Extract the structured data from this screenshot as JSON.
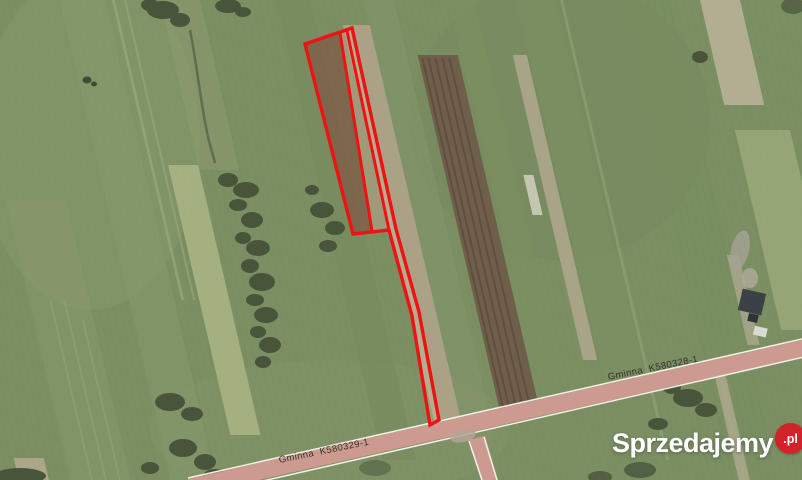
{
  "map": {
    "type": "aerial-satellite-view",
    "road_labels": [
      {
        "text": "Gminna  K580329-1"
      },
      {
        "text": "Gminna  K580328-1"
      }
    ],
    "road_surface_color": "#cc9a8e"
  },
  "parcel": {
    "outline_color": "#ee1212",
    "outer_points": "305,44 352,28 396,229 419,312 439,420 430,425 412,316 389,230 353,234",
    "divider_a_points": "340,33 372,231",
    "divider_b_points": "347,31 389,230",
    "fill_left_points": "305,44 340,33 372,231 353,234",
    "fill_middle_points": "340,33 347,31 389,230 372,231",
    "fill_strip_points": "347,31 352,28 396,229 419,312 439,420 430,425 412,316 389,230"
  },
  "watermark": {
    "brand": "Sprzedajemy",
    "tld": ".pl",
    "badge_color": "#d2232b",
    "text_color": "#ffffff"
  }
}
